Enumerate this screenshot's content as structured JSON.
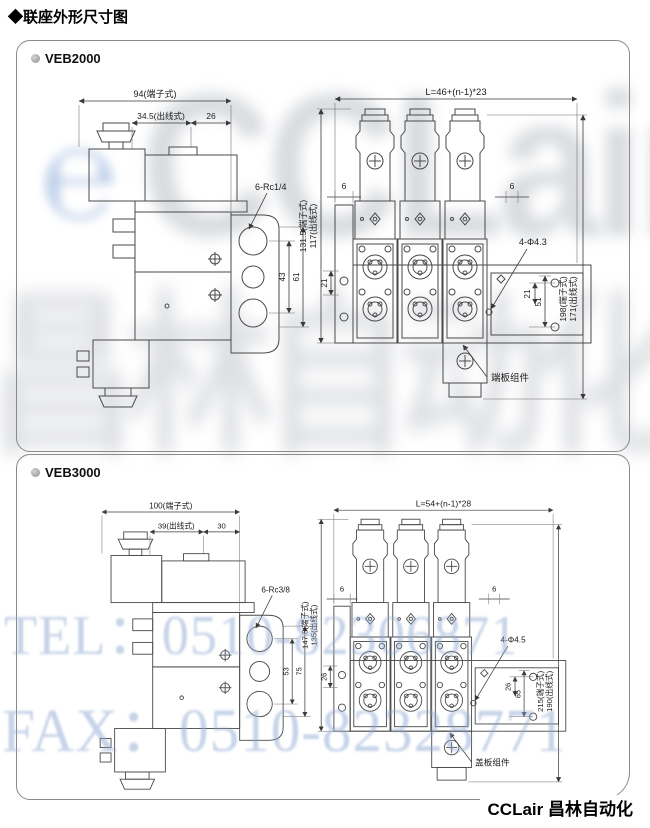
{
  "header": {
    "title": "◆联座外形尺寸图"
  },
  "watermark": {
    "logo_mark": "℮",
    "logo": "CCLair",
    "cn": "昌林自动化",
    "tel": "TEL：0510-82306871",
    "fax": "FAX：0510-82328771"
  },
  "footer": {
    "brand": "CCLair 昌林自动化"
  },
  "colors": {
    "watermark_blue": "#8ea7d1",
    "watermark_gray": "#c7cad0",
    "line": "#4a4a4a"
  },
  "panels": [
    {
      "model": "VEB2000",
      "side_view": {
        "width_terminal": "94(端子式)",
        "width_wire": "34.5(出线式)",
        "width_offset": "26",
        "port_thread": "6-Rc1/4",
        "port_pitch": "43",
        "port_span": "61"
      },
      "front_view": {
        "length_formula": "L=46+(n-1)*23",
        "edge_offset_left": "6",
        "edge_offset_right": "6",
        "height_terminal": "131.5(端子式)",
        "height_wire": "117(出线式)",
        "base_offset": "21",
        "mount_holes": "4-Φ4.3",
        "hole_pitch": "21",
        "hole_span": "51",
        "total_height_terminal": "198(端子式)",
        "total_height_wire": "171(出线式)",
        "end_plate": "端板组件"
      }
    },
    {
      "model": "VEB3000",
      "side_view": {
        "width_terminal": "100(端子式)",
        "width_wire": "39(出线式)",
        "width_offset": "30",
        "port_thread": "6-Rc3/8",
        "port_pitch": "53",
        "port_span": "75"
      },
      "front_view": {
        "length_formula": "L=54+(n-1)*28",
        "edge_offset_left": "6",
        "edge_offset_right": "6",
        "height_terminal": "147.5(端子式)",
        "height_wire": "135(出线式)",
        "base_offset": "26",
        "mount_holes": "4-Φ4.5",
        "hole_pitch": "26",
        "hole_span": "65",
        "total_height_terminal": "215(端子式)",
        "total_height_wire": "190(出线式)",
        "end_plate": "盖板组件"
      }
    }
  ]
}
